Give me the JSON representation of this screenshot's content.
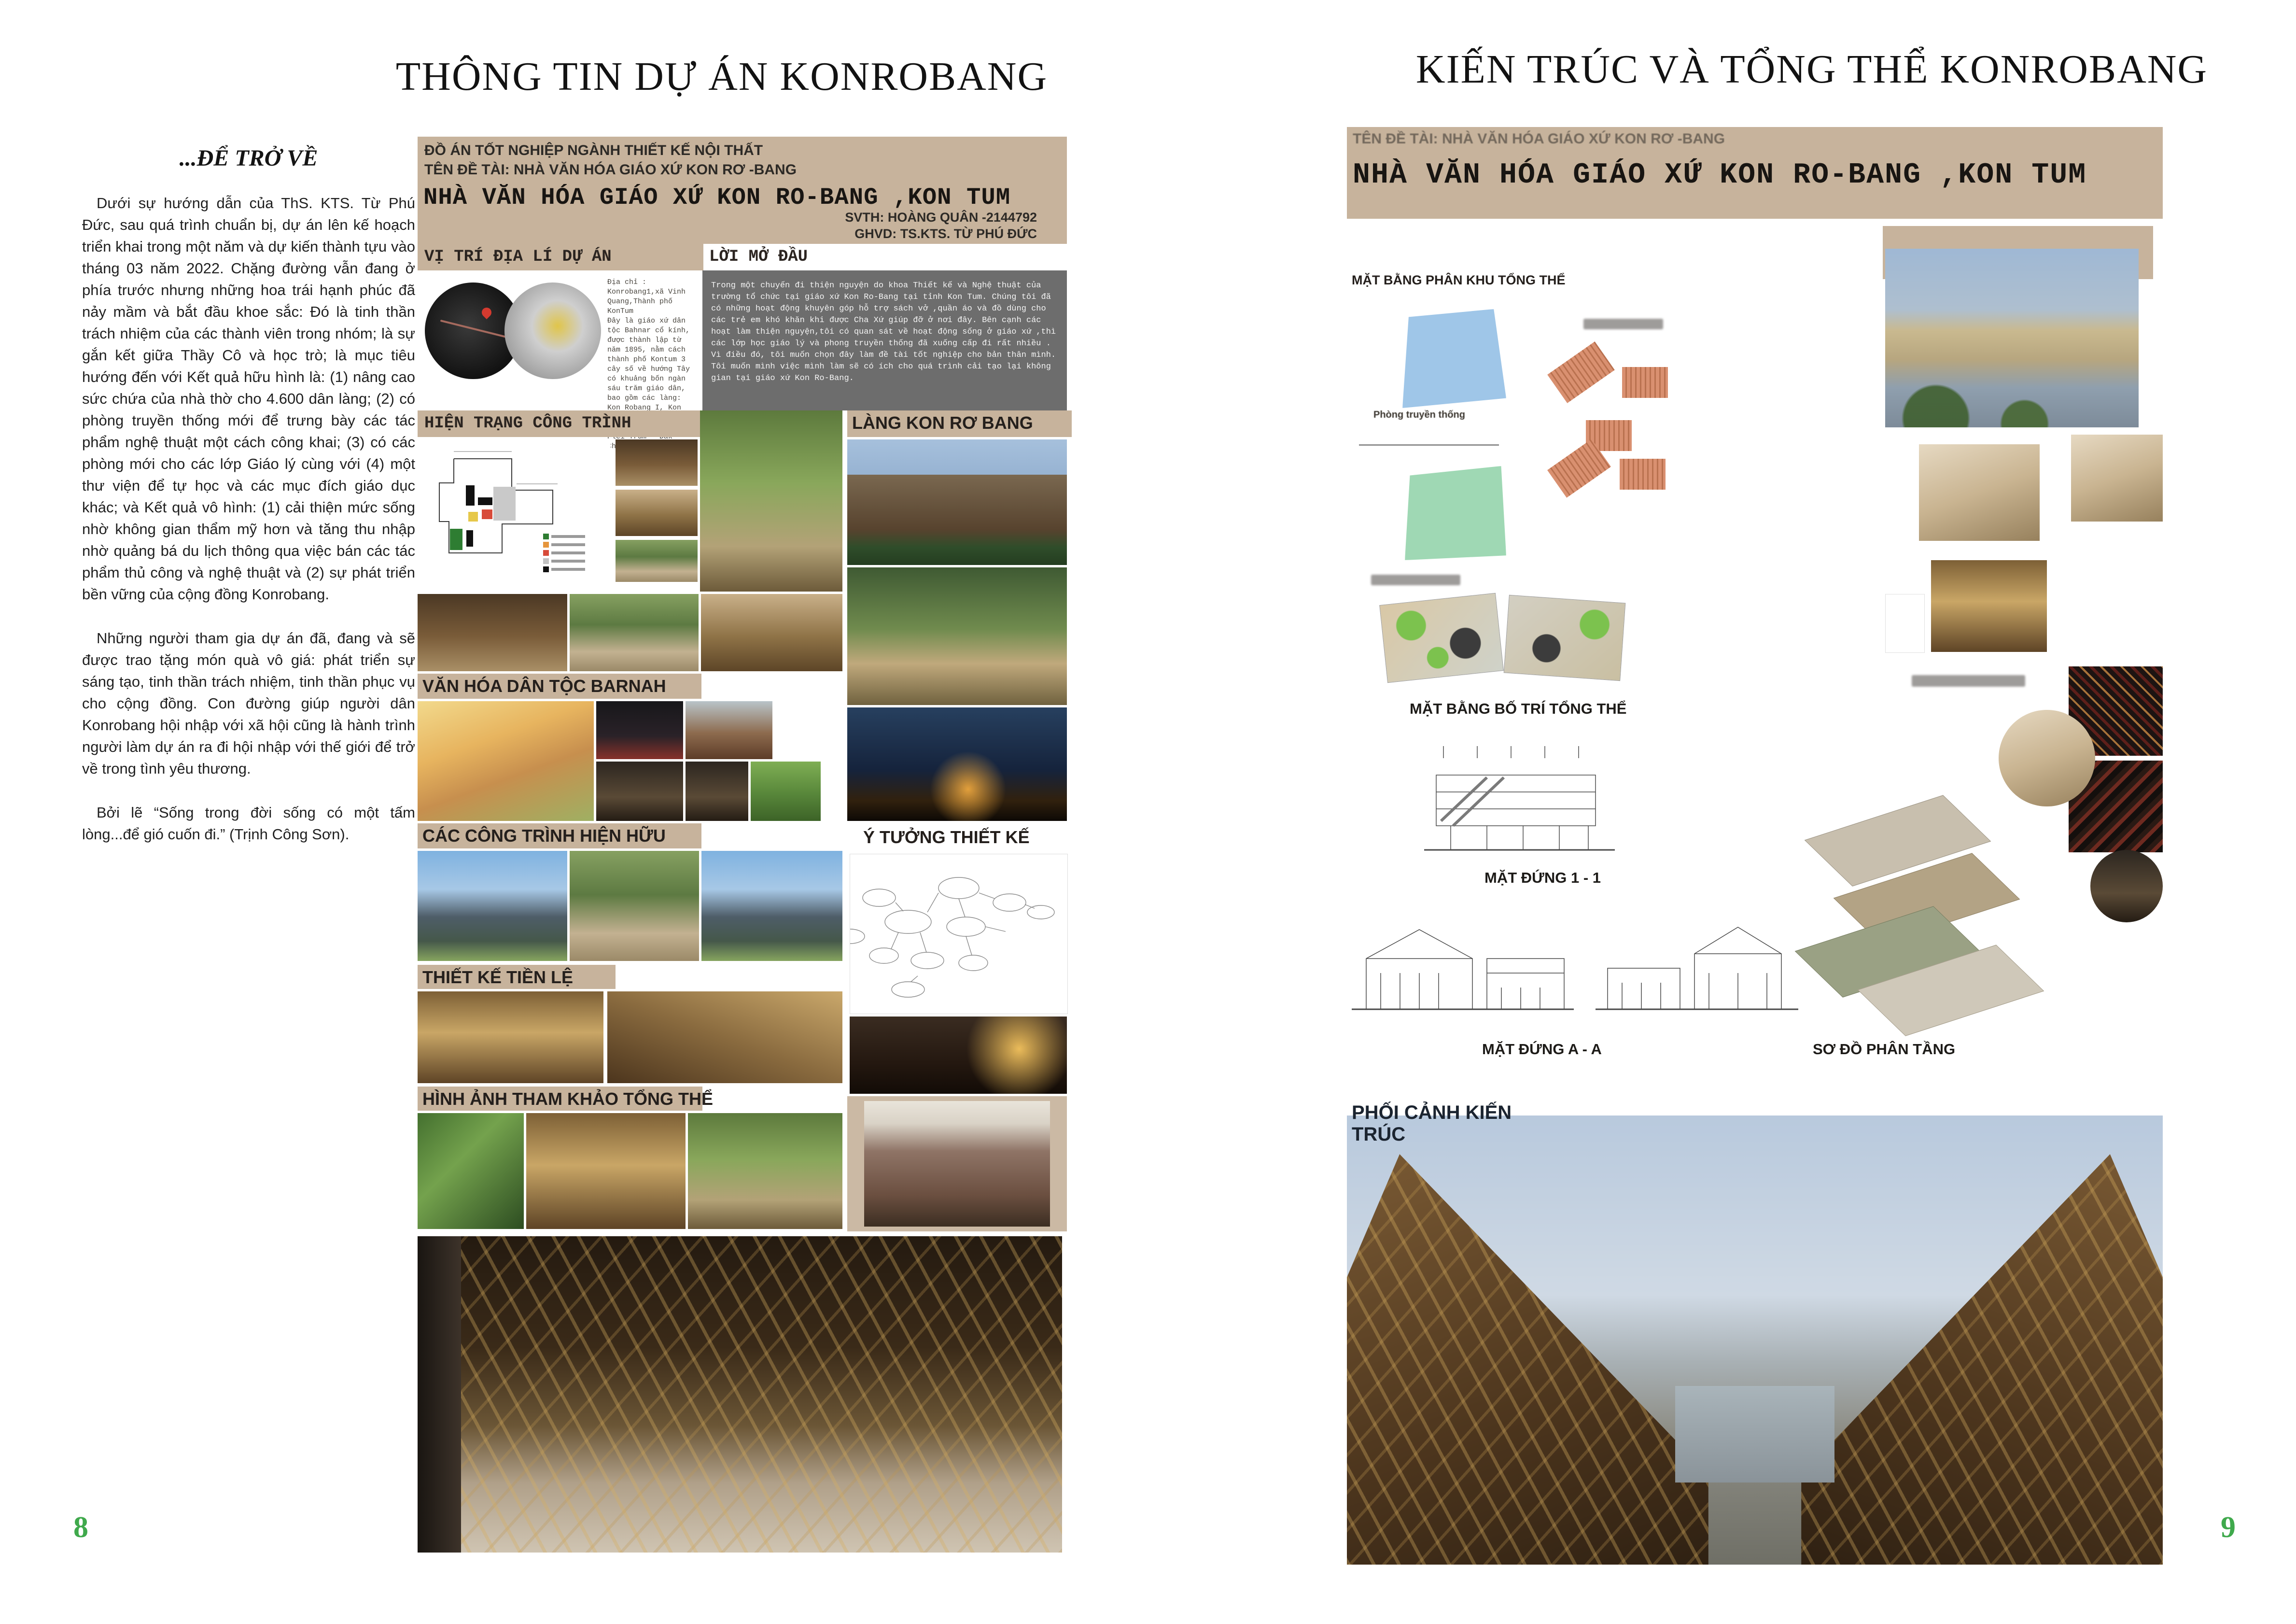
{
  "colors": {
    "accent_green": "#3fa94c",
    "poster_beige": "#c7b39c",
    "intro_gray": "#6d6d6d"
  },
  "left_page": {
    "header_title": "THÔNG TIN DỰ ÁN KONROBANG",
    "page_number": "8",
    "article": {
      "title": "...ĐỂ TRỞ VỀ",
      "paragraphs": [
        "Dưới sự hướng dẫn của ThS. KTS. Từ Phú Đức, sau quá trình chuẩn bị, dự án lên kế hoạch triển khai trong một năm và dự kiến thành tựu vào tháng 03 năm 2022. Chặng đường vẫn đang ở phía trước nhưng những hoa trái hạnh phúc đã nảy mầm và bắt đầu khoe sắc: Đó là tinh thần trách nhiệm của các thành viên trong nhóm; là sự gắn kết giữa Thầy Cô và học trò; là mục tiêu hướng đến với Kết quả hữu hình là: (1) nâng cao sức chứa của nhà thờ cho 4.600 dân làng; (2) có phòng truyền thống mới để trưng bày các tác phẩm nghệ thuật một cách công khai; (3) có các phòng mới cho các lớp Giáo lý cùng với (4) một thư viện để tự học và các mục đích giáo dục khác; và Kết quả vô hình: (1) cải thiện mức sống nhờ không gian thẩm mỹ hơn và tăng thu nhập nhờ quảng bá du lịch thông qua việc bán các tác phẩm thủ công và nghệ thuật và (2) sự phát triển bền vững của cộng đồng Konrobang.",
        "Những người tham gia dự án đã, đang và sẽ được trao tặng món quà vô giá: phát triển sự sáng tạo, tinh thần trách nhiệm, tinh thần phục vụ cho cộng đồng. Con đường giúp người dân Konrobang hội nhập với xã hội cũng là hành trình người làm dự án ra đi hội nhập với thế giới để trở về trong tình yêu thương.",
        "Bởi lẽ “Sống trong đời sống có một tấm lòng...để gió cuốn đi.” (Trịnh Công Sơn)."
      ]
    },
    "poster": {
      "header": {
        "line1": "ĐỒ ÁN TỐT NGHIỆP NGÀNH THIẾT KẾ NỘI THẤT",
        "line2": "TÊN ĐỀ TÀI: NHÀ VĂN HÓA GIÁO XỨ KON RƠ -BANG",
        "title": "NHÀ VĂN HÓA GIÁO XỨ KON RO-BANG ,KON TUM",
        "student": "SVTH: HOÀNG QUÂN -2144792",
        "advisor": "GHVD: TS.KTS. TỪ PHÚ ĐỨC"
      },
      "location": {
        "label": "VỊ TRÍ ĐỊA LÍ DỰ ÁN",
        "text": "Địa chỉ : Konrobang1,xã Vinh Quang,Thành phố KonTum\nĐây là giáo xứ dân tộc Bahnar cổ kính, được thành lập từ năm 1895, nằm cách thành phố Kontum 3 cây số về hướng Tây có khuảng bốn ngàn sáu trăm giáo dân, bao gồm các làng: Kon Robang I, Kon Robang II, Plei Tongia, Plei Don, Plei Trum - Đắk Choắt."
      },
      "intro": {
        "label": "LỜI MỞ ĐẦU",
        "text": "Trong một chuyến đi thiện nguyện do khoa Thiết kế và Nghệ thuật của trường tổ chức tại giáo xứ Kon Ro-Bang tại tỉnh Kon Tum. Chúng tôi đã có những hoạt động khuyên góp hỗ trợ sách vở ,quần áo và đồ dùng cho các trẻ em khó khăn khi được Cha Xứ giúp đỡ ở nơi đây. Bên cạnh các hoạt làm thiện nguyện,tôi có quan sát về hoạt động sống ở giáo xứ ,thì các lớp học giáo lý và phong truyền thống đã xuống cấp đi rất nhiều .\nVì điều đó, tôi muốn chọn đây làm đề tài tốt nghiệp cho bản thân mình. Tôi muốn mình việc mình làm sẽ có ích cho quá trình cải tạo lại không gian tại giáo xứ Kon Ro-Bang."
      },
      "labels": {
        "status": "HIỆN TRẠNG CÔNG TRÌNH",
        "village": "LÀNG KON RƠ BANG",
        "culture": "VĂN HÓA DÂN TỘC BARNAH",
        "existing": "CÁC CÔNG TRÌNH HIỆN HỮU",
        "idea": "Ý TƯỞNG THIẾT KẾ",
        "precedent": "THIẾT KẾ TIỀN LỆ",
        "reference": "HÌNH ẢNH THAM KHẢO TỔNG THỂ"
      }
    }
  },
  "right_page": {
    "header_title": "KIẾN TRÚC VÀ TỔNG THỂ KONROBANG",
    "page_number": "9",
    "poster": {
      "header_line": "TÊN ĐỀ TÀI: NHÀ VĂN HÓA GIÁO XỨ KON RƠ -BANG",
      "title": "NHÀ VĂN HÓA GIÁO XỨ KON RO-BANG ,KON TUM",
      "labels": {
        "zoning": "MẶT BẰNG PHÂN KHU TỔNG THỂ",
        "zone_blue": "Phòng truyền thống",
        "layout": "MẶT BẰNG BỐ TRÍ TỔNG THỂ",
        "elevation1": "MẶT ĐỨNG 1 - 1",
        "elevationA": "MẶT ĐỨNG A - A",
        "layers": "SƠ ĐỒ PHÂN TẦNG",
        "perspective": "PHỐI CẢNH KIẾN TRÚC"
      }
    }
  }
}
